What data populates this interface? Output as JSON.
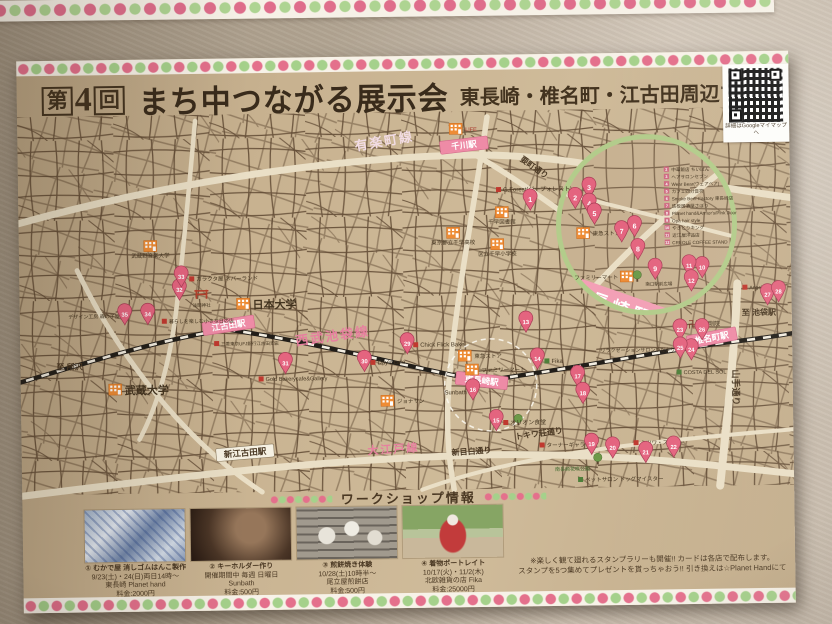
{
  "poster": {
    "title": {
      "no_pre": "第",
      "no_num": "4",
      "no_suf": "回",
      "logo": "まち中つながる展示会",
      "subtitle": "東長崎・椎名町・江古田周辺マップ"
    },
    "qr": {
      "caption": "詳細はGoogleマイマップへ"
    },
    "colors": {
      "paper": "#c8b290",
      "pink_accent": "#e4708c",
      "green_accent": "#a5d18b",
      "pin": "#e4647f",
      "rail_pink_text": "#e77f9f",
      "road_cream": "#eadfc6",
      "street_brown": "#5d4630",
      "inset_ring": "#b3cc8b"
    },
    "map": {
      "stations": [
        {
          "name": "千川駅",
          "x": 422,
          "y": 86,
          "w": 48,
          "rot": -6,
          "style": "pink"
        },
        {
          "name": "江古田駅",
          "x": 182,
          "y": 264,
          "w": 52,
          "rot": -8,
          "style": "pink"
        },
        {
          "name": "東長崎駅",
          "x": 436,
          "y": 316,
          "w": 52,
          "rot": 7,
          "style": "pink"
        },
        {
          "name": "椎名町駅",
          "x": 666,
          "y": 284,
          "w": 50,
          "rot": -10,
          "style": "pink"
        },
        {
          "name": "新江古田駅",
          "x": 194,
          "y": 390,
          "w": 58,
          "rot": -4,
          "style": "white"
        }
      ],
      "line_labels": [
        {
          "t": "有楽町線",
          "x": 338,
          "y": 94,
          "rot": -9,
          "cls": "lightpink",
          "fs": 13
        },
        {
          "t": "要町通り",
          "x": 502,
          "y": 106,
          "rot": 36,
          "cls": "dark",
          "fs": 8
        },
        {
          "t": "西武池袋線",
          "x": 276,
          "y": 288,
          "rot": -7,
          "cls": "pink",
          "fs": 13
        },
        {
          "t": "大江戸線",
          "x": 346,
          "y": 398,
          "rot": -3,
          "cls": "pink",
          "fs": 11
        },
        {
          "t": "新目白通り",
          "x": 430,
          "y": 400,
          "rot": -3,
          "cls": "dark",
          "fs": 8
        },
        {
          "t": "トキワ荘通り",
          "x": 494,
          "y": 385,
          "rot": -7,
          "cls": "dark",
          "fs": 8
        },
        {
          "t": "山手通り",
          "x": 712,
          "y": 318,
          "rot": 90,
          "cls": "dark",
          "fs": 9
        },
        {
          "t": "至 所沢",
          "x": 36,
          "y": 309,
          "rot": 0,
          "cls": "dark",
          "fs": 8
        },
        {
          "t": "至 池袋駅",
          "x": 722,
          "y": 264,
          "rot": 0,
          "cls": "dark",
          "fs": 8
        }
      ],
      "buildings": [
        {
          "label": "LIFE",
          "x": 432,
          "y": 68,
          "lp": "right"
        },
        {
          "label": "千早図書館",
          "x": 477,
          "y": 152,
          "lp": "below"
        },
        {
          "label": "東京都立千早高校",
          "x": 428,
          "y": 172,
          "lp": "below"
        },
        {
          "label": "区立千早小学校",
          "x": 472,
          "y": 184,
          "lp": "below"
        },
        {
          "label": "武蔵野音楽大学",
          "x": 125,
          "y": 181,
          "lp": "below"
        },
        {
          "label": "日本大学",
          "x": 217,
          "y": 240,
          "lp": "right",
          "big": true
        },
        {
          "label": "武蔵大学",
          "x": 88,
          "y": 324,
          "lp": "right",
          "big": true
        },
        {
          "label": "東急ストア",
          "x": 438,
          "y": 295,
          "lp": "right"
        },
        {
          "label": "ファミリーマート",
          "x": 445,
          "y": 309,
          "lp": "right"
        },
        {
          "label": "ジョナサン",
          "x": 360,
          "y": 339,
          "lp": "right"
        },
        {
          "label": "東急ストア",
          "x": 558,
          "y": 174,
          "lp": "right"
        },
        {
          "label": "ファミリーマート",
          "x": 601,
          "y": 218,
          "lp": "left"
        }
      ],
      "trees": [
        {
          "x": 576,
          "y": 408
        },
        {
          "x": 497,
          "y": 368
        },
        {
          "x": 618,
          "y": 226
        }
      ],
      "torii": {
        "x": 182,
        "y": 240,
        "label": "浅間神社"
      },
      "labels": [
        {
          "t": "G.Forest(ジーフォレスト)",
          "x": 478,
          "y": 137,
          "sq": "red",
          "anchor": "start",
          "fs": 6
        },
        {
          "t": "Fika",
          "x": 524,
          "y": 309,
          "sq": "green",
          "anchor": "start",
          "fs": 6
        },
        {
          "t": "オリオン食堂",
          "x": 482,
          "y": 370,
          "sq": "red",
          "anchor": "start",
          "fs": 6
        },
        {
          "t": "Sunbath",
          "x": 446,
          "y": 339,
          "sq": "red",
          "anchor": "end",
          "fs": 6
        },
        {
          "t": "リラクゼーションサロンひだまり",
          "x": 655,
          "y": 299,
          "sq": "red",
          "anchor": "end",
          "fs": 5
        },
        {
          "t": "Chick Flick Bake",
          "x": 393,
          "y": 291,
          "sq": "red",
          "anchor": "start",
          "fs": 6
        },
        {
          "t": "Day's cafe",
          "x": 350,
          "y": 308,
          "sq": "red",
          "anchor": "start",
          "fs": 6
        },
        {
          "t": "Gold Bakerycafe&Gallery",
          "x": 238,
          "y": 323,
          "sq": "red",
          "anchor": "start",
          "fs": 5.5
        },
        {
          "t": "ガラクタ屋 ネバーランド",
          "x": 170,
          "y": 222,
          "sq": "red",
          "anchor": "start",
          "fs": 5.5
        },
        {
          "t": "デザイン工房 森の子屋",
          "x": 100,
          "y": 258,
          "sq": "red",
          "anchor": "end",
          "fs": 5
        },
        {
          "t": "暮らしを楽しむ小さな日の店",
          "x": 142,
          "y": 264,
          "sq": "red",
          "anchor": "start",
          "fs": 5
        },
        {
          "t": "ミツワ・ストアー",
          "x": 612,
          "y": 392,
          "sq": "red",
          "anchor": "start",
          "fs": 5.5
        },
        {
          "t": "ターナーギャラリー",
          "x": 518,
          "y": 393,
          "sq": "red",
          "anchor": "start",
          "fs": 5.5
        },
        {
          "t": "ペットサロン ドッグマイスター",
          "x": 556,
          "y": 428,
          "sq": "green",
          "anchor": "start",
          "fs": 5.5
        },
        {
          "t": "南長崎花咲公園",
          "x": 568,
          "y": 417,
          "anchor": "end",
          "fs": 5,
          "color": "#3f6b2e"
        },
        {
          "t": "南口駅前広場",
          "x": 626,
          "y": 233,
          "anchor": "start",
          "fs": 4.5
        },
        {
          "t": "COSTA DEL SOL",
          "x": 656,
          "y": 322,
          "sq": "green",
          "anchor": "start",
          "fs": 5.5
        },
        {
          "t": "卍",
          "x": 668,
          "y": 276,
          "anchor": "start",
          "fs": 10,
          "color": "#7a2a20"
        },
        {
          "t": "金剛院",
          "x": 682,
          "y": 274,
          "anchor": "start",
          "fs": 6
        },
        {
          "t": "Angel Rock",
          "x": 723,
          "y": 238,
          "sq": "red",
          "anchor": "start",
          "fs": 5
        },
        {
          "t": "三菱東京UFJ銀行江古田支店",
          "x": 194,
          "y": 287,
          "sq": "red",
          "anchor": "start",
          "fs": 4.5
        }
      ],
      "pins": [
        {
          "n": 1,
          "x": 512,
          "y": 156
        },
        {
          "n": 13,
          "x": 506,
          "y": 278
        },
        {
          "n": 14,
          "x": 517,
          "y": 315
        },
        {
          "n": 15,
          "x": 475,
          "y": 376
        },
        {
          "n": 16,
          "x": 452,
          "y": 345
        },
        {
          "n": 17,
          "x": 557,
          "y": 333
        },
        {
          "n": 18,
          "x": 562,
          "y": 350
        },
        {
          "n": 19,
          "x": 570,
          "y": 401
        },
        {
          "n": 20,
          "x": 591,
          "y": 405
        },
        {
          "n": 21,
          "x": 624,
          "y": 410
        },
        {
          "n": 22,
          "x": 652,
          "y": 405
        },
        {
          "n": 23,
          "x": 660,
          "y": 288
        },
        {
          "n": 24,
          "x": 671,
          "y": 308
        },
        {
          "n": 25,
          "x": 660,
          "y": 306
        },
        {
          "n": 26,
          "x": 682,
          "y": 288
        },
        {
          "n": 27,
          "x": 748,
          "y": 254
        },
        {
          "n": 28,
          "x": 759,
          "y": 251
        },
        {
          "n": 29,
          "x": 387,
          "y": 298
        },
        {
          "n": 30,
          "x": 344,
          "y": 315
        },
        {
          "n": 31,
          "x": 265,
          "y": 316
        },
        {
          "n": 32,
          "x": 160,
          "y": 241
        },
        {
          "n": 33,
          "x": 162,
          "y": 228
        },
        {
          "n": 34,
          "x": 128,
          "y": 265
        },
        {
          "n": 35,
          "x": 105,
          "y": 265
        }
      ],
      "inset": {
        "station": "東長崎駅",
        "pins": [
          {
            "n": 2,
            "x": 557,
            "y": 155
          },
          {
            "n": 3,
            "x": 571,
            "y": 145
          },
          {
            "n": 4,
            "x": 571,
            "y": 161
          },
          {
            "n": 5,
            "x": 576,
            "y": 171
          },
          {
            "n": 6,
            "x": 616,
            "y": 184
          },
          {
            "n": 7,
            "x": 603,
            "y": 189
          },
          {
            "n": 8,
            "x": 619,
            "y": 207
          },
          {
            "n": 9,
            "x": 636,
            "y": 227
          },
          {
            "n": 10,
            "x": 683,
            "y": 226
          },
          {
            "n": 11,
            "x": 670,
            "y": 224
          },
          {
            "n": 12,
            "x": 672,
            "y": 239
          }
        ],
        "legend": [
          {
            "n": 2,
            "t": "中華飯店 ちいばん"
          },
          {
            "n": 3,
            "t": "ヘアサロンセブン"
          },
          {
            "n": 4,
            "t": "Wear Bear(ウェアベア)"
          },
          {
            "n": 5,
            "t": "カフェ四分音符"
          },
          {
            "n": 6,
            "t": "Smoke Beer Factory 東長崎店"
          },
          {
            "n": 7,
            "t": "鉄板居酒屋さぼり"
          },
          {
            "n": 8,
            "t": "Planet hand&Armor's/Pink Door"
          },
          {
            "n": 9,
            "t": "Opa hair style"
          },
          {
            "n": 10,
            "t": "やきとりキング"
          },
          {
            "n": 11,
            "t": "近江屋洋品店"
          },
          {
            "n": 12,
            "t": "CREOLE COFFEE STAND"
          }
        ]
      }
    },
    "workshops": {
      "header": "ワークショップ情報",
      "items": [
        {
          "num": "①",
          "title": "むかで屋 消しゴムはんこ製作",
          "line2": "9/23(土)・24(日)両日14時〜",
          "line3": "東長崎 Planet hand",
          "fee": "料金:2000円"
        },
        {
          "num": "②",
          "title": "キーホルダー作り",
          "line2": "開催期間中 毎週 日曜日",
          "line3": "Sunbath",
          "fee": "料金:500円"
        },
        {
          "num": "③",
          "title": "煎餅焼き体験",
          "line2": "10/28(土)10時半〜",
          "line3": "尾立屋煎餅店",
          "fee": "料金:500円"
        },
        {
          "num": "④",
          "title": "着物ポートレイト",
          "line2": "10/17(火)・11/2(木)",
          "line3": "北欧雑貨の店 Fika",
          "fee": "料金:25000円"
        }
      ],
      "note1": "※楽しく観て廻れるスタンプラリーも開催!! カードは各店で配布します。",
      "note2": "スタンプを5つ集めてプレゼントを貰っちゃおう!! 引き換えは☆Planet Handにて"
    }
  }
}
